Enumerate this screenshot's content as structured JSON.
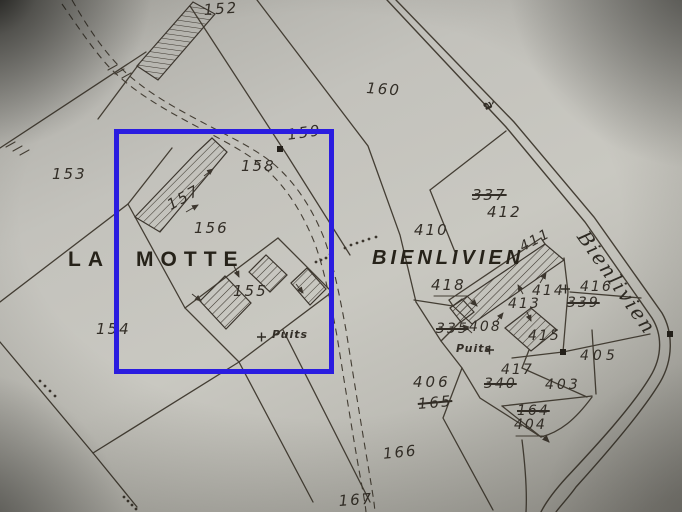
{
  "map": {
    "type": "cadastral-plan-photo",
    "region_labels": {
      "la_motte": "LA MOTTE",
      "bienlivien": "BIENLIVIEN"
    },
    "road_labels": {
      "a_road": "à",
      "bienlivien_road": "Bienlivien"
    },
    "well_labels": {
      "puits_west": "Puits",
      "puits_east": "Puits"
    },
    "parcel_numbers": {
      "l152": "152",
      "l153": "153",
      "l154": "154",
      "l155": "155",
      "l156": "156",
      "l157": "157",
      "l158": "158",
      "l159": "159",
      "l160": "160",
      "l166": "166",
      "l167": "167",
      "l403": "403",
      "l404": "404",
      "l405": "405",
      "l406": "406",
      "l408": "408",
      "l410": "410",
      "l411": "411",
      "l412": "412",
      "l413": "413",
      "l414": "414",
      "l415": "415",
      "l416": "416",
      "l417": "417",
      "l418": "418"
    },
    "struck_parcel_numbers": {
      "l337": "337",
      "l339": "339",
      "l335": "335",
      "l340": "340",
      "l165": "165",
      "l164": "164"
    },
    "highlight": {
      "color": "#2a1ce0"
    }
  }
}
